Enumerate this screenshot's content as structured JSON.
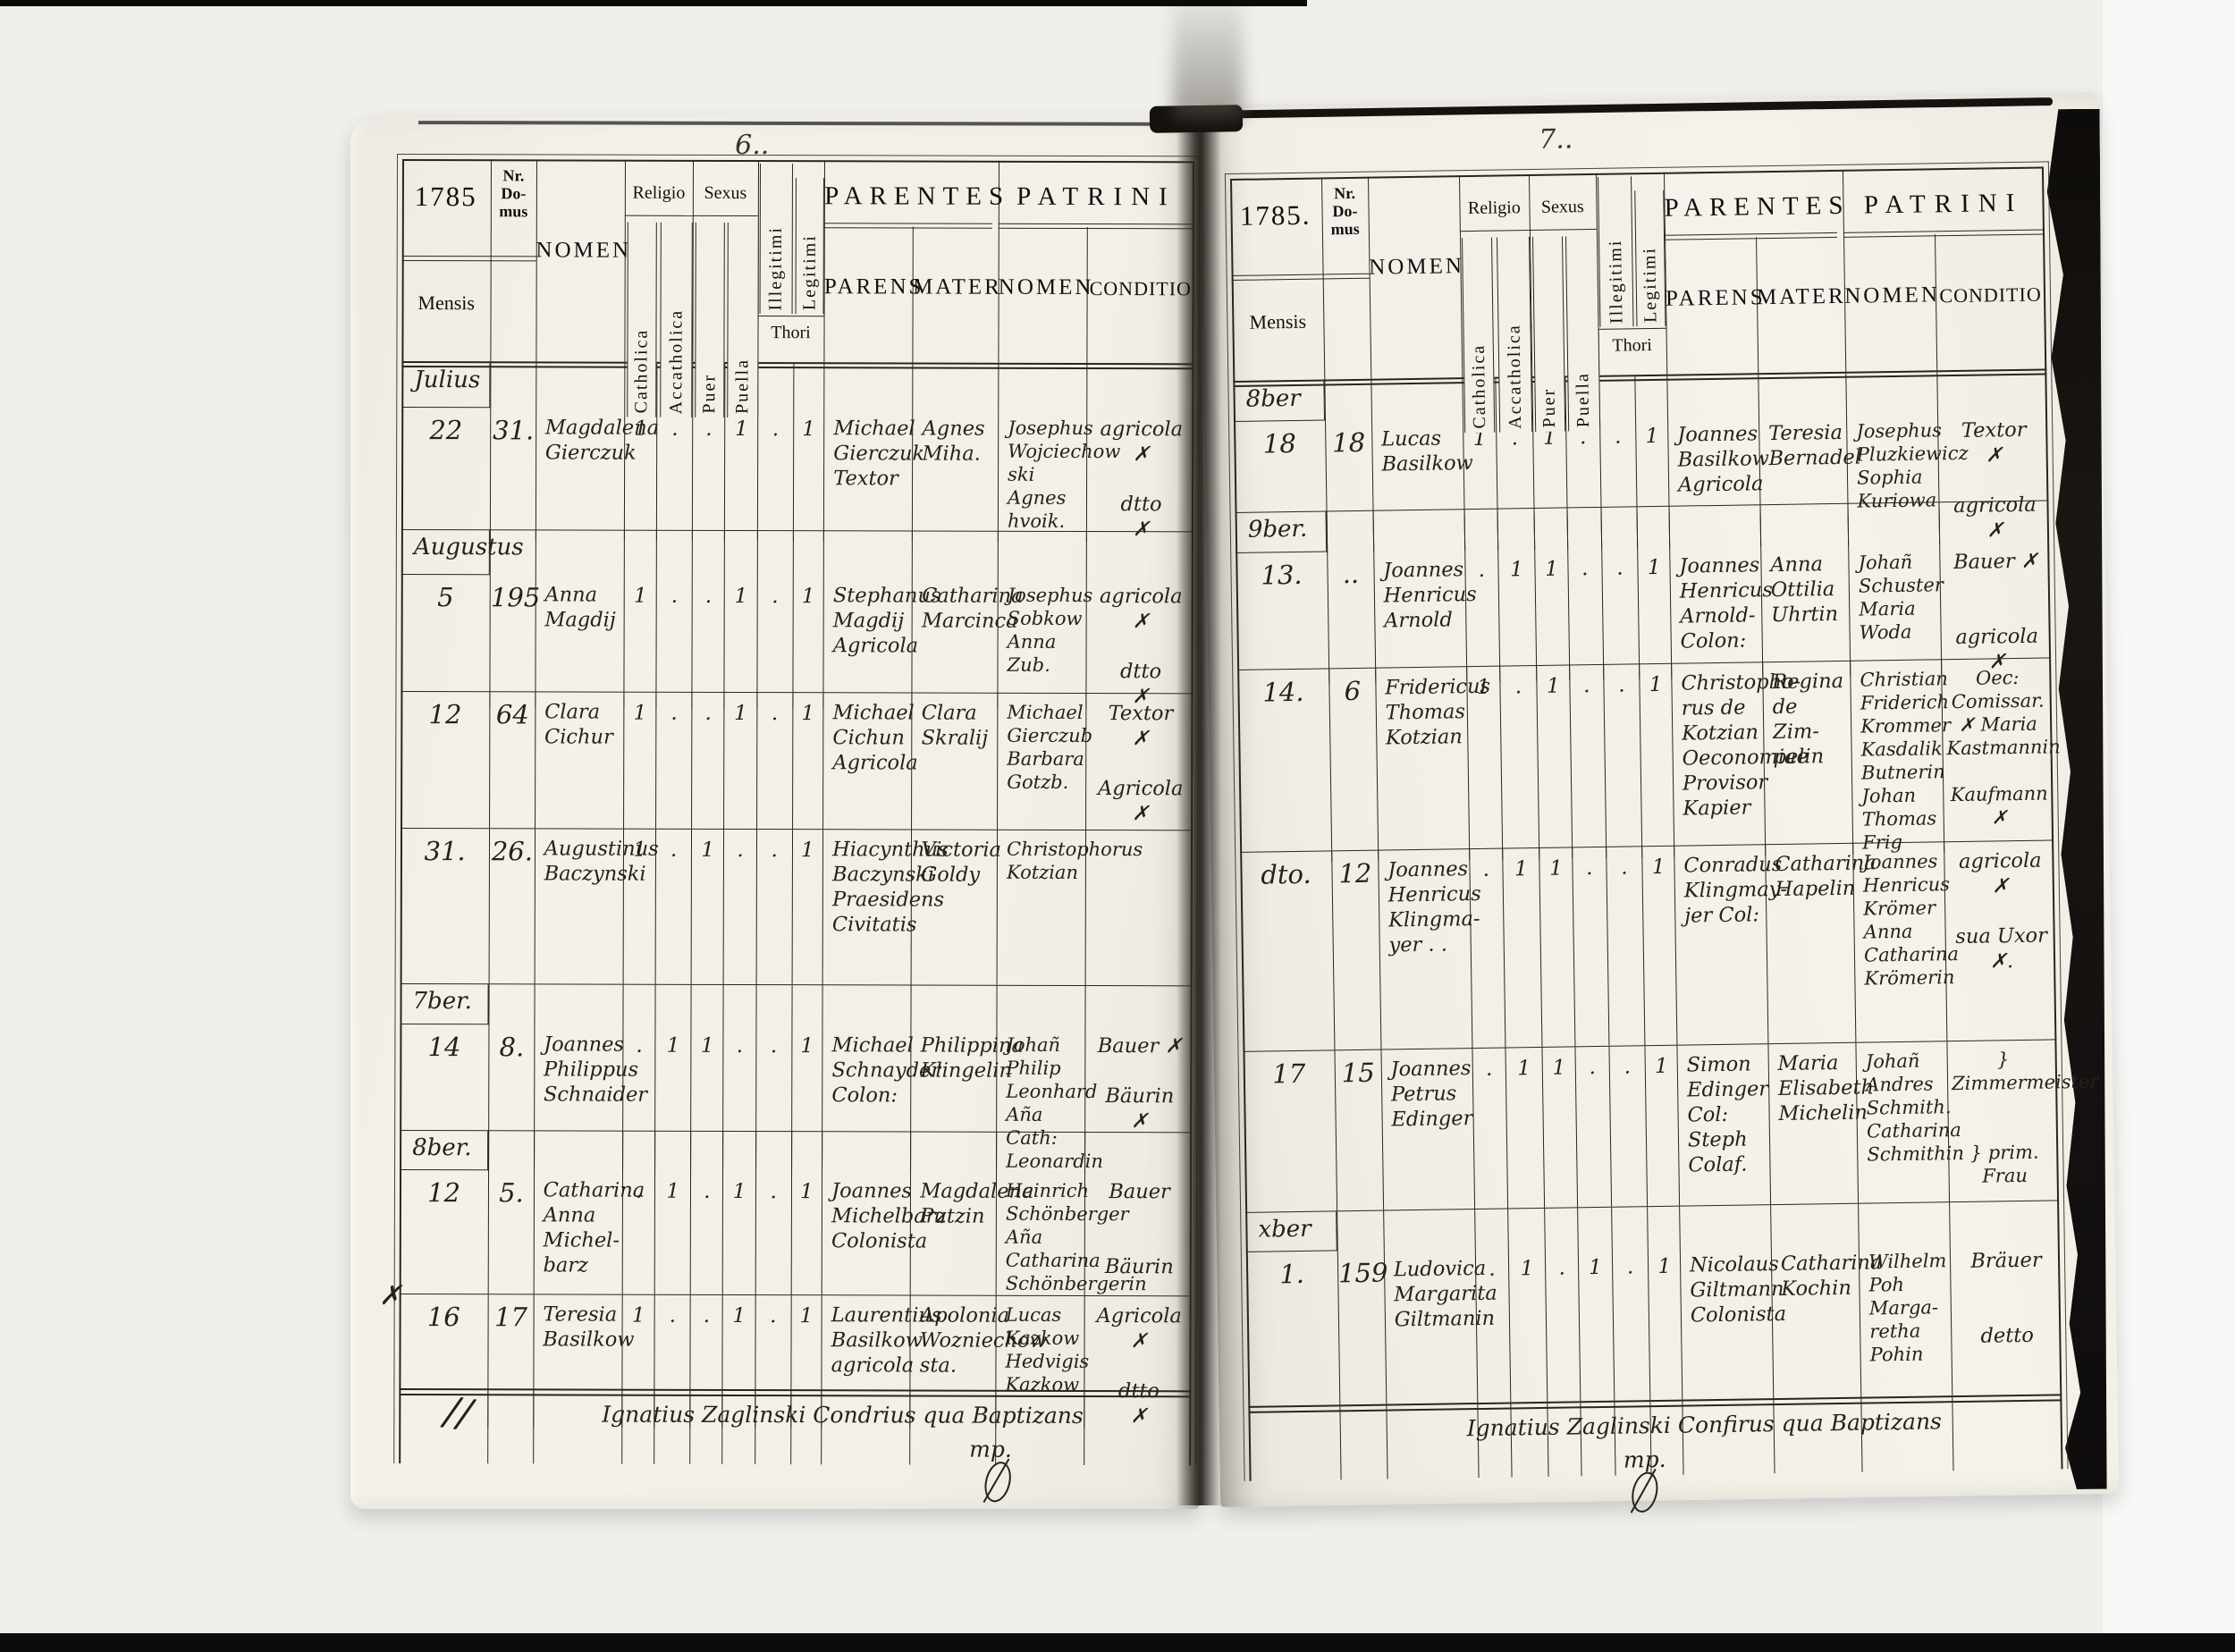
{
  "colors": {
    "background": "#efefec",
    "paper": "#f3f0e8",
    "table_line": "#2b251e",
    "ink": "#26211b"
  },
  "header": {
    "nr_domus": "Nr.\nDo-\nmus",
    "mensis": "Mensis",
    "nomen": "NOMEN",
    "religio": "Religio",
    "catholica": "Catholica",
    "acatholica": "Accatholica",
    "sexus": "Sexus",
    "puer": "Puer",
    "puella": "Puella",
    "illegitimi": "Illegitimi",
    "legitimi": "Legitimi",
    "thori": "Thori",
    "parentes": "PARENTES",
    "parens": "PARENS",
    "mater": "MATER",
    "patrini": "PATRINI",
    "patrini_nomen": "NOMEN",
    "conditio": "CONDITIO"
  },
  "left_page": {
    "page_number": "6..",
    "year": "1785",
    "months": [
      "Julius",
      "Augustus",
      "7ber.",
      "8ber."
    ],
    "rows": [
      {
        "day": "22",
        "nr": "31.",
        "nomen": "Magdalena\nGierczuk",
        "marks": [
          "1",
          ".",
          ".",
          "1",
          ".",
          "1"
        ],
        "parens": "Michael\nGierczuk\nTextor",
        "mater": "Agnes\nMiha.",
        "patrini": "Josephus\nWojciechow\nski\nAgnes\nhvoik.",
        "conditio": "agricola\n✗\n\ndtto\n✗"
      },
      {
        "day": "5",
        "nr": "195",
        "nomen": "Anna\nMagdij",
        "marks": [
          "1",
          ".",
          ".",
          "1",
          ".",
          "1"
        ],
        "parens": "Stephanus\nMagdij\nAgricola",
        "mater": "Catharina\nMarcinca",
        "patrini": "Josephus\nSobkow\nAnna\nZub.",
        "conditio": "agricola\n✗\n\ndtto\n✗"
      },
      {
        "day": "12",
        "nr": "64",
        "nomen": "Clara\nCichur",
        "marks": [
          "1",
          ".",
          ".",
          "1",
          ".",
          "1"
        ],
        "parens": "Michael\nCichun\nAgricola",
        "mater": "Clara\nSkralij",
        "patrini": "Michael\nGierczub\nBarbara\nGotzb.",
        "conditio": "Textor\n✗\n\nAgricola\n✗"
      },
      {
        "day": "31.",
        "nr": "26.",
        "nomen": "Augustinus\nBaczynski",
        "marks": [
          "1",
          ".",
          "1",
          ".",
          ".",
          "1"
        ],
        "parens": "Hiacynthus\nBaczynski\nPraesidens\nCivitatis",
        "mater": "Victoria\nGoldy",
        "patrini": "Christophorus\nKotzian",
        "conditio": ""
      },
      {
        "day": "14",
        "nr": "8.",
        "nomen": "Joannes\nPhilippus\nSchnaider",
        "marks": [
          ".",
          "1",
          "1",
          ".",
          ".",
          "1"
        ],
        "parens": "Michael\nSchnayder\nColon:",
        "mater": "Philippina\nKlingelin",
        "patrini": "Johañ Philip\nLeonhard\nAña Cath:\nLeonardin",
        "conditio": "Bauer ✗\n\nBäurin\n✗"
      },
      {
        "day": "12",
        "nr": "5.",
        "nomen": "Catharina\nAnna\nMichel-\nbarz",
        "marks": [
          ".",
          "1",
          ".",
          "1",
          ".",
          "1"
        ],
        "parens": "Joannes\nMichelbarz\nColonista",
        "mater": "Magdalena\nPutzin",
        "patrini": "Heinrich\nSchönberger\nAña Catharina\nSchönbergerin",
        "conditio": "Bauer\n\n\nBäurin"
      },
      {
        "day": "16",
        "nr": "17",
        "nomen": "Teresia\nBasilkow",
        "marks": [
          "1",
          ".",
          ".",
          "1",
          ".",
          "1"
        ],
        "parens": "Laurentius\nBasilkow\nagricola",
        "mater": "Apolonia\nWozniechow\nsta.",
        "patrini": "Lucas\nKazkow\nHedvigis\nKazkow",
        "conditio": "Agricola\n✗\n\ndtto\n✗"
      }
    ],
    "signature": "Ignatius Zaglinski Condrius qua Baptizans",
    "signature_mp": "mp.",
    "margin_mark": "✗",
    "margin_flourish": "//"
  },
  "right_page": {
    "page_number": "7..",
    "year": "1785.",
    "months": [
      "8ber",
      "9ber.",
      "xber"
    ],
    "rows": [
      {
        "day": "18",
        "nr": "18",
        "nomen": "Lucas\nBasilkow",
        "marks": [
          "1",
          ".",
          "1",
          ".",
          ".",
          "1"
        ],
        "parens": "Joannes\nBasilkow\nAgricola",
        "mater": "Teresia\nBernadel",
        "patrini": "Josephus\nPluzkiewicz\nSophia\nKuriowa",
        "conditio": "Textor\n✗\n\nagricola\n✗"
      },
      {
        "day": "13.",
        "nr": "..",
        "nomen": "Joannes\nHenricus\nArnold",
        "marks": [
          ".",
          "1",
          "1",
          ".",
          ".",
          "1"
        ],
        "parens": "Joannes\nHenricus\nArnold-\nColon:",
        "mater": "Anna\nOttilia\nUhrtin",
        "patrini": "Johañ\nSchuster\nMaria\nWoda",
        "conditio": "Bauer ✗\n\n\nagricola ✗"
      },
      {
        "day": "14.",
        "nr": "6",
        "nomen": "Fridericus\nThomas\nKotzian",
        "marks": [
          "1",
          ".",
          "1",
          ".",
          ".",
          "1"
        ],
        "parens": "Christopho-\nrus de\nKotzian\nOeconomiae\nProvisor\nKapier",
        "mater": "Regina\nde Zim-\npelin",
        "patrini": "Christian\nFriderich\nKrommer\nKasdalik\nButnerin\nJohan Thomas\nFrig",
        "conditio": "Oec: Comissar.\n✗ Maria\nKastmannin\n\nKaufmann ✗"
      },
      {
        "day": "dto.",
        "nr": "12",
        "nomen": "Joannes\nHenricus\nKlingma-\nyer . .",
        "marks": [
          ".",
          "1",
          "1",
          ".",
          ".",
          "1"
        ],
        "parens": "Conradus\nKlingmay-\njer Col:",
        "mater": "Catharina\nHapelin",
        "patrini": "Joannes\nHenricus\nKrömer\nAnna\nCatharina\nKrömerin",
        "conditio": "agricola\n✗\n\nsua Uxor\n✗."
      },
      {
        "day": "17",
        "nr": "15",
        "nomen": "Joannes\nPetrus\nEdinger",
        "marks": [
          ".",
          "1",
          "1",
          ".",
          ".",
          "1"
        ],
        "parens": "Simon\nEdinger\nCol: Steph\nColaf.",
        "mater": "Maria\nElisabeth\nMichelin",
        "patrini": "Johañ\nAndres\nSchmith.\nCatharina\nSchmithin",
        "conditio": "} Zimmermeister\n\n\n} prim. Frau"
      },
      {
        "day": "1.",
        "nr": "159",
        "nomen": "Ludovica\nMargarita\nGiltmanin",
        "marks": [
          ".",
          "1",
          ".",
          "1",
          ".",
          "1"
        ],
        "parens": "Nicolaus\nGiltmann\nColonista",
        "mater": "Catharina\nKochin",
        "patrini": "Wilhelm\nPoh\nMarga-\nretha\nPohin",
        "conditio": "Bräuer\n\n\ndetto"
      }
    ],
    "signature": "Ignatius Zaglinski Confirus qua Baptizans",
    "signature_mp": "mp."
  }
}
